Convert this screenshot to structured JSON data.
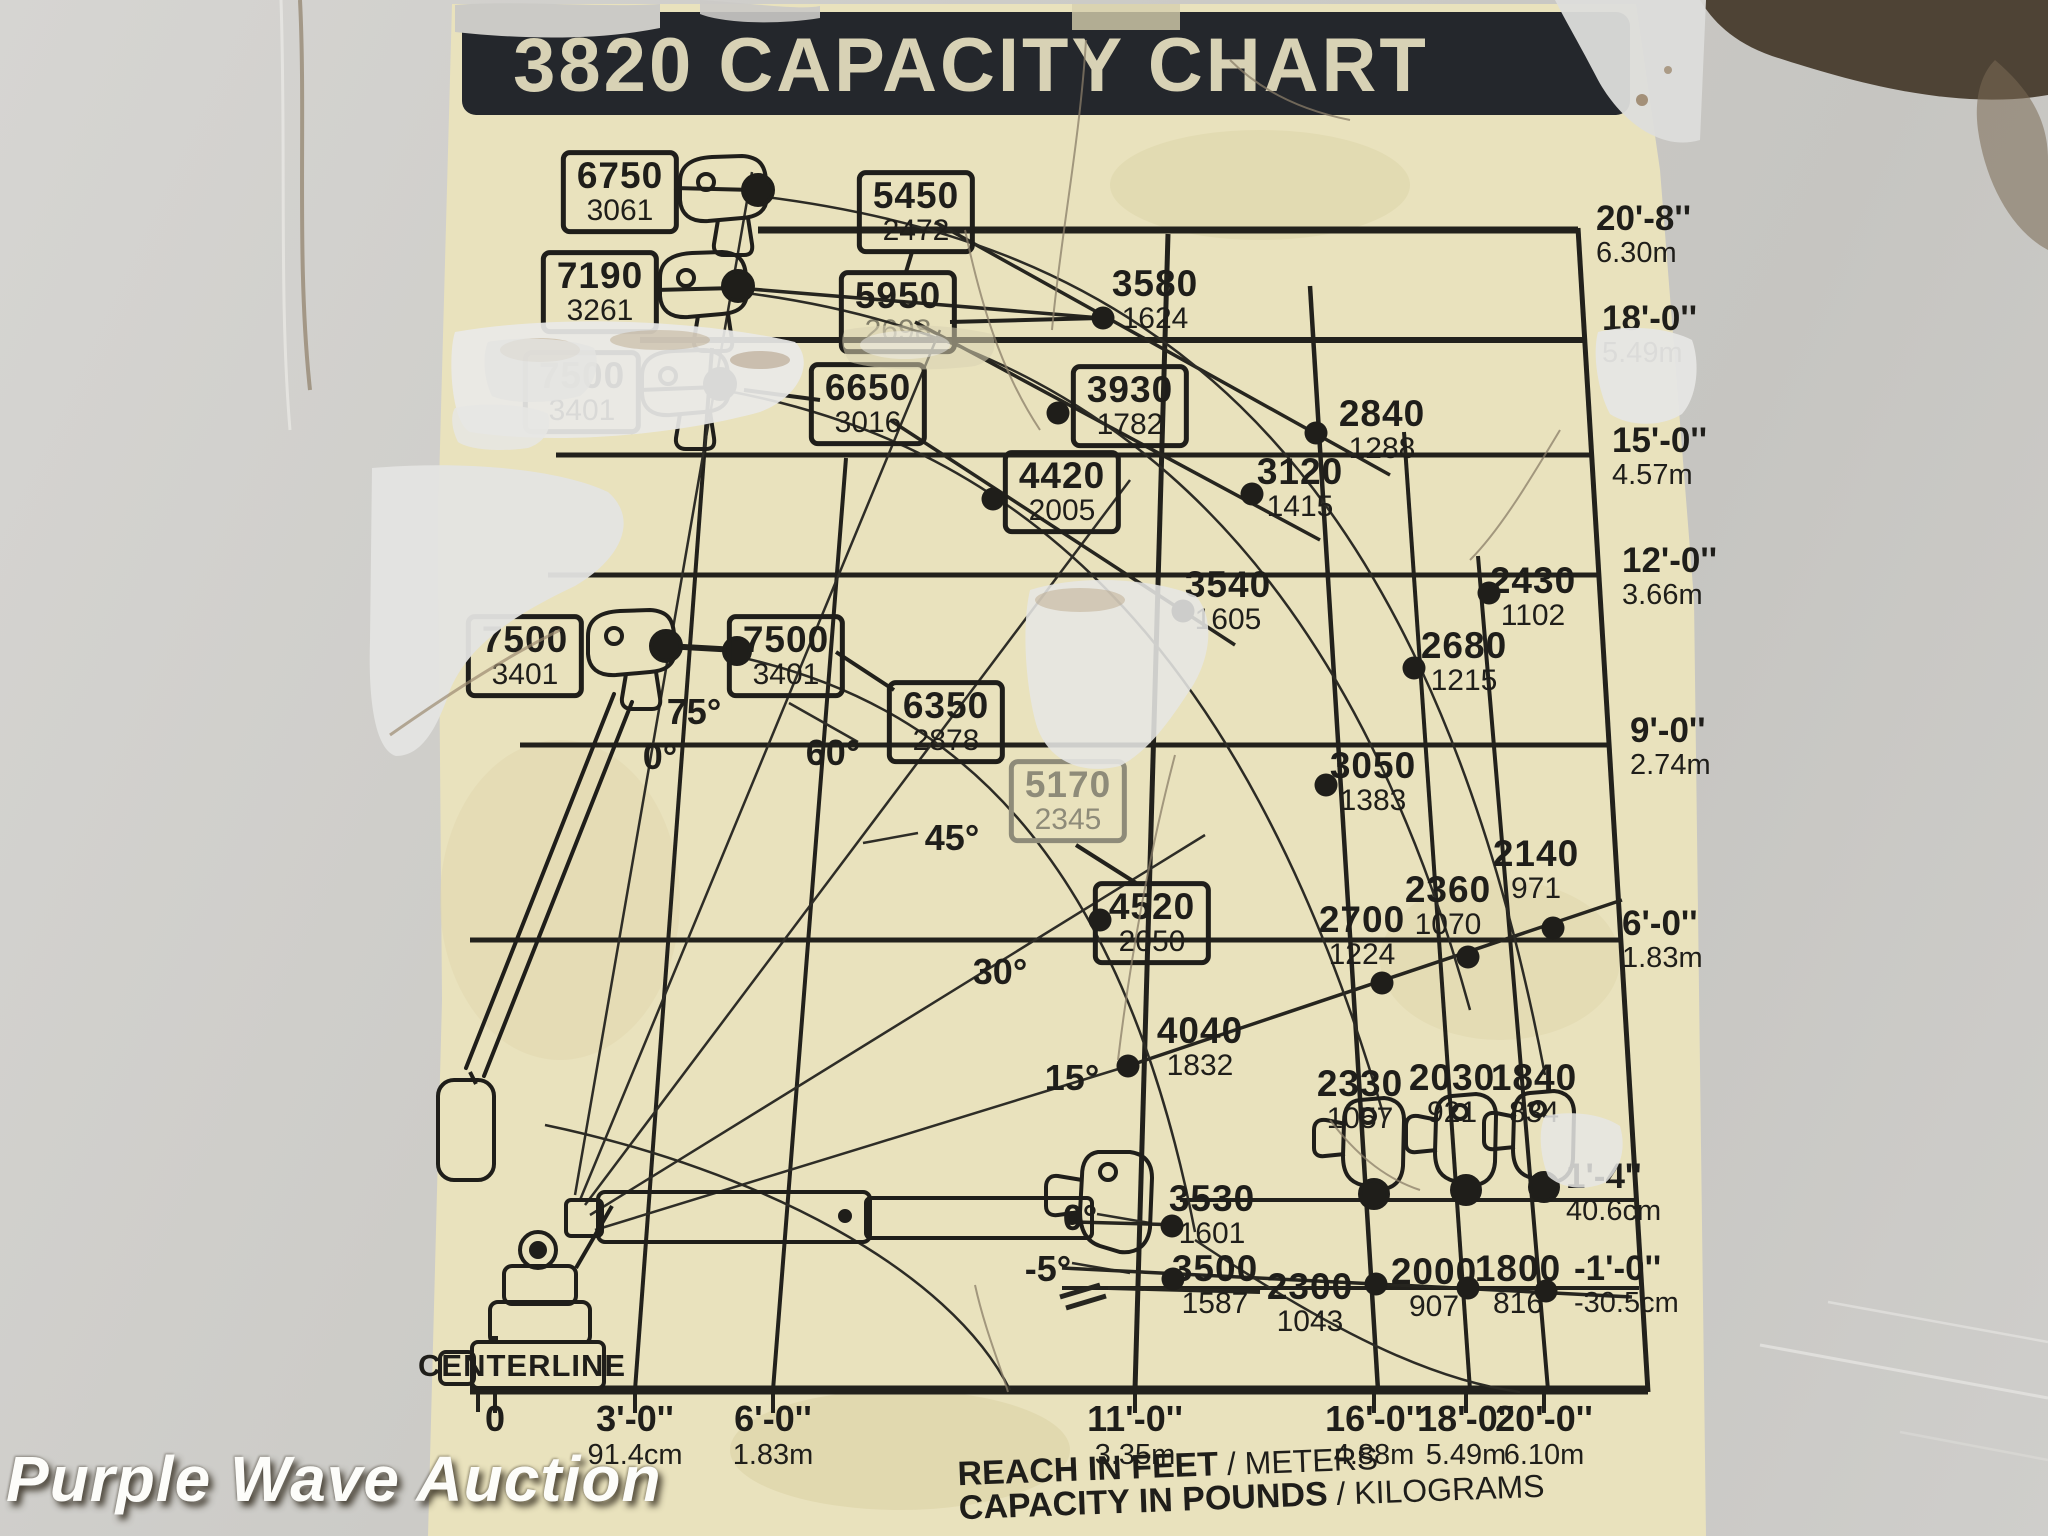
{
  "watermark": {
    "text": "Purple Wave Auction"
  },
  "sticker": {
    "title": "3820 CAPACITY CHART"
  },
  "chart_data": {
    "type": "scatter",
    "title": "3820 CAPACITY CHART",
    "xlabel": "REACH IN FEET / METERS",
    "ylabel": "HEIGHT IN FEET / METERS",
    "units_note": "CAPACITY IN POUNDS / KILOGRAMS",
    "centerline": "CENTERLINE",
    "caption": {
      "reach_bold": "REACH IN FEET",
      "reach_light": " / METERS",
      "cap_bold": "CAPACITY IN POUNDS",
      "cap_light": " / KILOGRAMS"
    },
    "reach_ticks": [
      {
        "ft": "0",
        "m": "",
        "x": 495
      },
      {
        "ft": "3'-0''",
        "m": "91.4cm",
        "x": 635
      },
      {
        "ft": "6'-0''",
        "m": "1.83m",
        "x": 773
      },
      {
        "ft": "11'-0''",
        "m": "3.35m",
        "x": 1135
      },
      {
        "ft": "16'-0''",
        "m": "4.88m",
        "x": 1374
      },
      {
        "ft": "18'-0''",
        "m": "5.49m",
        "x": 1466
      },
      {
        "ft": "20'-0''",
        "m": "6.10m",
        "x": 1544
      }
    ],
    "height_ticks": [
      {
        "ft": "20'-8''",
        "m": "6.30m",
        "x": 1596,
        "y": 200
      },
      {
        "ft": "18'-0''",
        "m": "5.49m",
        "x": 1602,
        "y": 300
      },
      {
        "ft": "15'-0''",
        "m": "4.57m",
        "x": 1612,
        "y": 422
      },
      {
        "ft": "12'-0''",
        "m": "3.66m",
        "x": 1622,
        "y": 542
      },
      {
        "ft": "9'-0''",
        "m": "2.74m",
        "x": 1630,
        "y": 712
      },
      {
        "ft": "6'-0''",
        "m": "1.83m",
        "x": 1622,
        "y": 905
      },
      {
        "ft": "1'-4''",
        "m": "40.6cm",
        "x": 1566,
        "y": 1158
      },
      {
        "ft": "-1'-0''",
        "m": "-30.5cm",
        "x": 1574,
        "y": 1250
      }
    ],
    "angle_labels": [
      {
        "t": "75°",
        "x": 694,
        "y": 712
      },
      {
        "t": "0°",
        "x": 660,
        "y": 757
      },
      {
        "t": "60°",
        "x": 833,
        "y": 753
      },
      {
        "t": "45°",
        "x": 952,
        "y": 838
      },
      {
        "t": "30°",
        "x": 1000,
        "y": 972
      },
      {
        "t": "15°",
        "x": 1072,
        "y": 1078
      },
      {
        "t": "0°",
        "x": 1080,
        "y": 1218
      },
      {
        "t": "-5°",
        "x": 1048,
        "y": 1269
      }
    ],
    "capacities": [
      {
        "lb": "6750",
        "kg": "3061",
        "x": 620,
        "y": 192,
        "boxed": true
      },
      {
        "lb": "7190",
        "kg": "3261",
        "x": 600,
        "y": 292,
        "boxed": true
      },
      {
        "lb": "7500",
        "kg": "3401",
        "x": 582,
        "y": 392,
        "boxed": true,
        "damaged": true
      },
      {
        "lb": "5450",
        "kg": "2472",
        "x": 916,
        "y": 212,
        "boxed": true
      },
      {
        "lb": "5950",
        "kg": "2698",
        "x": 898,
        "y": 312,
        "boxed": true,
        "kg_faded": true
      },
      {
        "lb": "6650",
        "kg": "3016",
        "x": 868,
        "y": 404,
        "boxed": true
      },
      {
        "lb": "3930",
        "kg": "1782",
        "x": 1130,
        "y": 406,
        "boxed": true,
        "dot": [
          1058,
          413
        ]
      },
      {
        "lb": "4420",
        "kg": "2005",
        "x": 1062,
        "y": 492,
        "boxed": true,
        "dot": [
          993,
          499
        ]
      },
      {
        "lb": "7500",
        "kg": "3401",
        "x": 525,
        "y": 656,
        "boxed": true
      },
      {
        "lb": "7500",
        "kg": "3401",
        "x": 786,
        "y": 656,
        "boxed": true
      },
      {
        "lb": "6350",
        "kg": "2878",
        "x": 946,
        "y": 722,
        "boxed": true
      },
      {
        "lb": "5170",
        "kg": "2345",
        "x": 1068,
        "y": 801,
        "boxed": true,
        "faded": true
      },
      {
        "lb": "4520",
        "kg": "2050",
        "x": 1152,
        "y": 923,
        "boxed": true,
        "dot": [
          1100,
          920
        ]
      },
      {
        "lb": "3580",
        "kg": "1624",
        "x": 1155,
        "y": 300,
        "dot": [
          1103,
          318
        ]
      },
      {
        "lb": "2840",
        "kg": "1288",
        "x": 1382,
        "y": 430,
        "dot": [
          1316,
          433
        ]
      },
      {
        "lb": "3120",
        "kg": "1415",
        "x": 1300,
        "y": 488,
        "dot": [
          1252,
          494
        ]
      },
      {
        "lb": "3540",
        "kg": "1605",
        "x": 1228,
        "y": 601,
        "dot": [
          1183,
          611
        ]
      },
      {
        "lb": "2430",
        "kg": "1102",
        "x": 1533,
        "y": 597,
        "dot": [
          1489,
          593
        ]
      },
      {
        "lb": "2680",
        "kg": "1215",
        "x": 1464,
        "y": 662,
        "dot": [
          1414,
          668
        ]
      },
      {
        "lb": "3050",
        "kg": "1383",
        "x": 1373,
        "y": 782,
        "dot": [
          1326,
          785
        ]
      },
      {
        "lb": "2700",
        "kg": "1224",
        "x": 1362,
        "y": 936,
        "dot": [
          1382,
          983
        ]
      },
      {
        "lb": "2360",
        "kg": "1070",
        "x": 1448,
        "y": 906,
        "dot": [
          1468,
          957
        ]
      },
      {
        "lb": "2140",
        "kg": "971",
        "x": 1536,
        "y": 870,
        "dot": [
          1553,
          928
        ]
      },
      {
        "lb": "4040",
        "kg": "1832",
        "x": 1200,
        "y": 1047,
        "dot": [
          1128,
          1066
        ]
      },
      {
        "lb": "3530",
        "kg": "1601",
        "x": 1212,
        "y": 1215,
        "dot": [
          1172,
          1226
        ]
      },
      {
        "lb": "3500",
        "kg": "1587",
        "x": 1215,
        "y": 1285,
        "dot": [
          1173,
          1279
        ]
      },
      {
        "lb": "2330",
        "kg": "1057",
        "x": 1360,
        "y": 1100
      },
      {
        "lb": "2030",
        "kg": "921",
        "x": 1452,
        "y": 1094
      },
      {
        "lb": "1840",
        "kg": "834",
        "x": 1534,
        "y": 1094
      },
      {
        "lb": "2300",
        "kg": "1043",
        "x": 1310,
        "y": 1303,
        "dot": [
          1376,
          1284
        ]
      },
      {
        "lb": "2000",
        "kg": "907",
        "x": 1434,
        "y": 1288,
        "dot": [
          1468,
          1288
        ]
      },
      {
        "lb": "1800",
        "kg": "816",
        "x": 1518,
        "y": 1285,
        "dot": [
          1546,
          1291
        ]
      }
    ]
  }
}
